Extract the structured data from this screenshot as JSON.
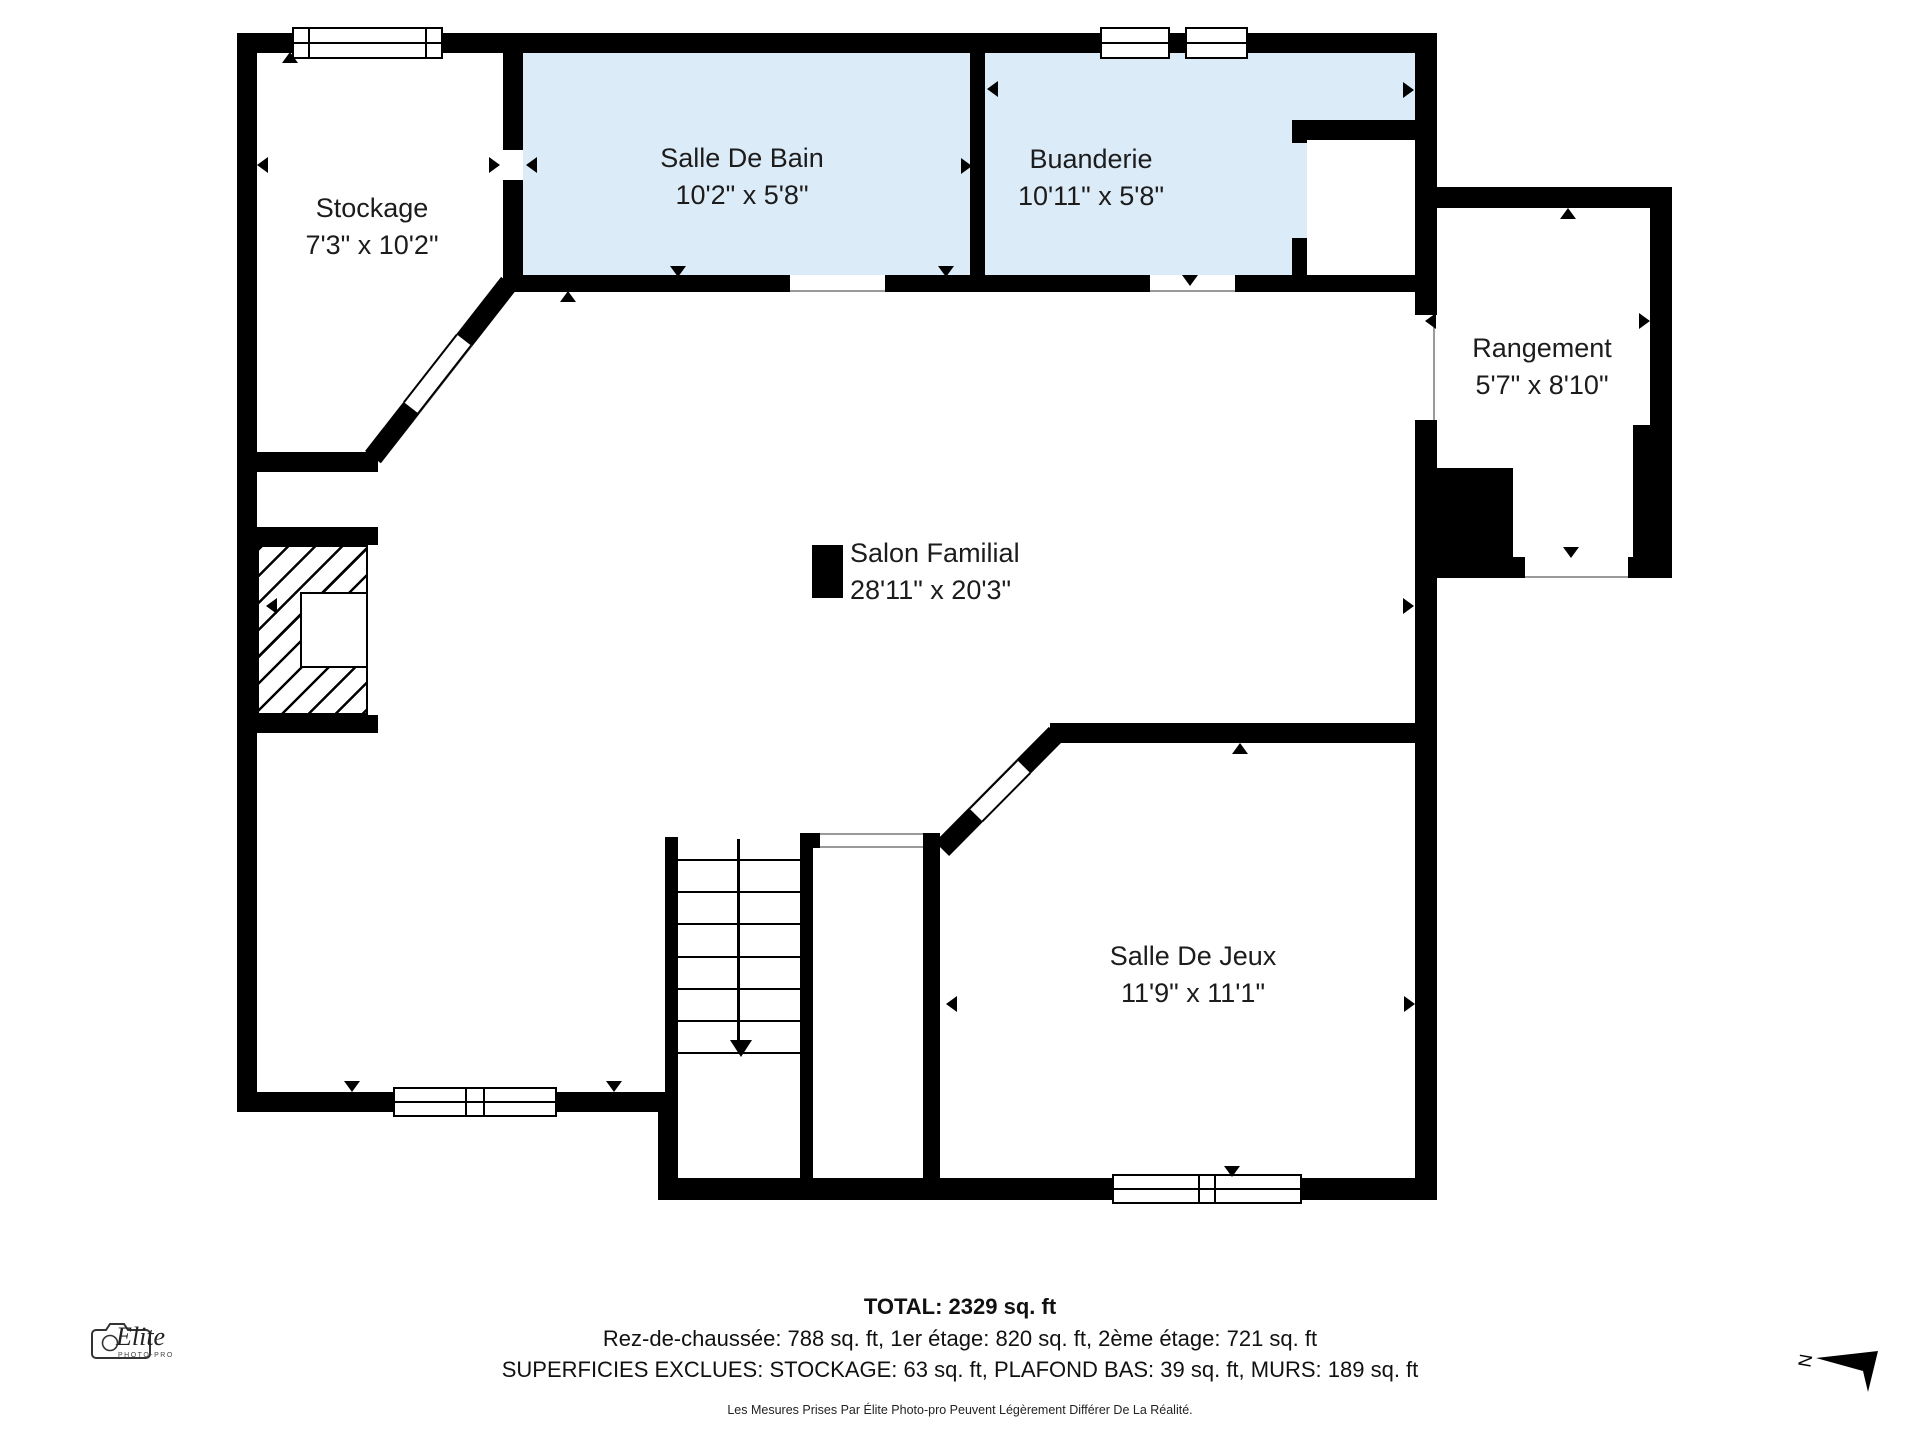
{
  "plan": {
    "rooms": {
      "stockage": {
        "name": "Stockage",
        "dims": "7'3\" x 10'2\""
      },
      "salle_de_bain": {
        "name": "Salle De Bain",
        "dims": "10'2\" x 5'8\""
      },
      "buanderie": {
        "name": "Buanderie",
        "dims": "10'11\" x 5'8\""
      },
      "rangement": {
        "name": "Rangement",
        "dims": "5'7\" x 8'10\""
      },
      "salon_familial": {
        "name": "Salon Familial",
        "dims": "28'11\" x 20'3\""
      },
      "salle_de_jeux": {
        "name": "Salle De Jeux",
        "dims": "11'9\" x 11'1\""
      }
    },
    "summary": {
      "total": "TOTAL: 2329 sq. ft",
      "floors": "Rez-de-chaussée: 788 sq. ft, 1er étage: 820 sq. ft, 2ème étage: 721 sq. ft",
      "excluded": "SUPERFICIES EXCLUES: STOCKAGE: 63 sq. ft, PLAFOND BAS: 39 sq. ft, MURS: 189 sq. ft",
      "disclaimer": "Les Mesures Prises Par Élite Photo-pro Peuvent Légèrement Différer De La Réalité."
    },
    "logo": {
      "brand": "Elite",
      "sub": "PHOTO-PRO"
    },
    "compass": {
      "north_label": "N"
    },
    "colors": {
      "wall": "#000000",
      "wet_room_fill": "#dcebf8",
      "text": "#1c1c1c"
    }
  }
}
